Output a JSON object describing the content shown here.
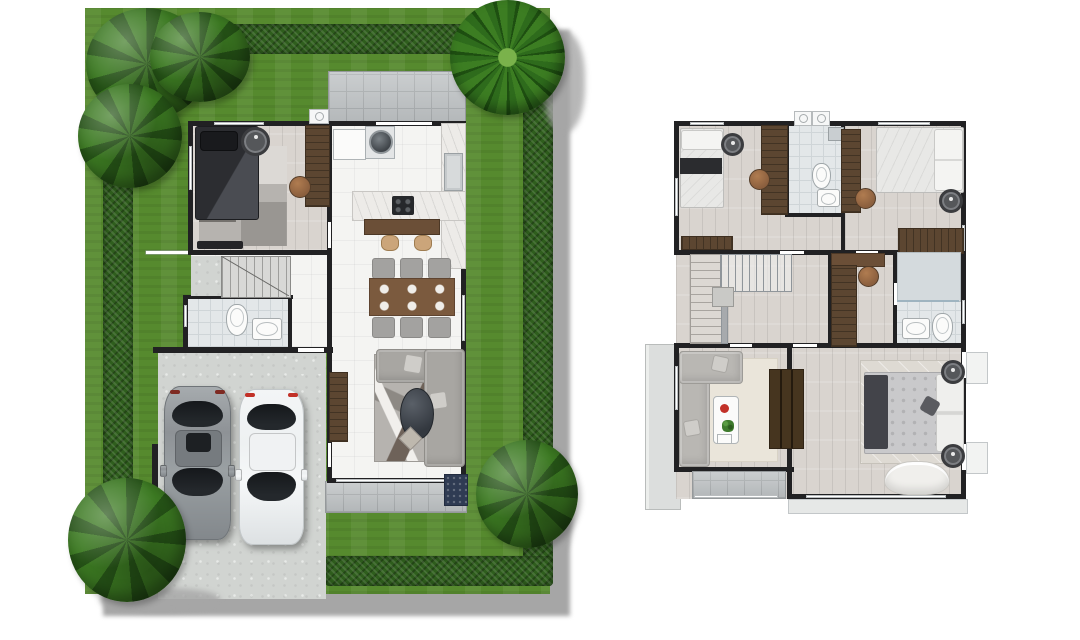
{
  "title": "two-storey-house-floor-plans",
  "canvas": {
    "width": 1080,
    "height": 640
  },
  "colors": {
    "shadow": "#a6a6a6",
    "grass": "#568a2e",
    "hedge": "#2f5e1d",
    "tree": "#3c7a22",
    "tree_dark": "#265417",
    "palm": "#2e6b1c",
    "driveway": "#d1d4d1",
    "tile": "#bcc0c2",
    "tile_line": "#a6aaac",
    "floor_white": "#f4f4f2",
    "wood": "#d9d4cf",
    "wall": "#212123",
    "bath": "#e3e7e9",
    "marble": "#edebe8",
    "furniture_wood": "#5c4631",
    "bar_wood": "#6b4f37",
    "chair_tan": "#8b5f3e",
    "stool_tan": "#cba57a",
    "sofa_gray": "#a8a6a2",
    "sofa_light": "#b9b7b3",
    "rug_gray": "#b6b3af",
    "rug_cream": "#eae5da",
    "rug_master": "#dedad3",
    "bed_dark": "#313236",
    "bed_white": "#e8e8e6",
    "blanket_navy": "#43444a",
    "car_gray": "#8e9296",
    "car_white": "#eef1f2",
    "glass": "#24282c",
    "accent_red": "#c23128",
    "plant_green": "#3e7b2d",
    "doormat_navy": "#2f3b53",
    "arc_line": "#8f979c"
  },
  "plans": [
    {
      "id": "first-floor",
      "position": "left",
      "site": {
        "lawn": "hedge-bordered garden",
        "trees": [
          "tree-top-left-cluster",
          "tree-left",
          "palm-top-right",
          "tree-bottom-left",
          "tree-bottom-right"
        ],
        "shadow": "cast-to-bottom-right"
      },
      "rooms": [
        "bedroom",
        "kitchen",
        "dining-area",
        "living-room",
        "bathroom",
        "stair-hall",
        "utility-patio",
        "entry-porch",
        "terrace",
        "carport-driveway"
      ],
      "furniture": {
        "bedroom": [
          "double-bed-dark",
          "patchwork-rug",
          "round-rug",
          "wardrobe",
          "chair",
          "tv-console"
        ],
        "kitchen": [
          "fridge",
          "washing-machine",
          "l-shaped-counter",
          "sink",
          "stove",
          "breakfast-bar",
          "bar-stools x2"
        ],
        "dining-area": [
          "dining-table",
          "dining-chairs x6"
        ],
        "living-room": [
          "l-shaped-sofa",
          "abstract-rug",
          "oval-coffee-table",
          "side-table",
          "tv-console",
          "doormat"
        ],
        "bathroom": [
          "toilet",
          "washbasin"
        ],
        "stair-hall": [
          "staircase",
          "under-stair-storage"
        ]
      },
      "vehicles": [
        "car-gray",
        "car-white"
      ],
      "exterior": [
        "ac-unit",
        "side-gate",
        "fence-stub"
      ]
    },
    {
      "id": "second-floor",
      "position": "right",
      "rooms": [
        "bedroom-2",
        "bathroom-2",
        "bedroom-3",
        "stair-hall",
        "wardrobe-nook",
        "bathroom-3",
        "family-room",
        "master-bedroom",
        "balcony-left",
        "terrace-rear",
        "juliet-balconies-right",
        "balcony-bottom"
      ],
      "furniture": {
        "bedroom-2": [
          "single-bed",
          "round-rug",
          "wardrobe",
          "chair",
          "dresser"
        ],
        "bathroom-2": [
          "shower",
          "toilet",
          "washbasin"
        ],
        "bedroom-3": [
          "double-bed",
          "wardrobe",
          "chair",
          "round-rug",
          "closet"
        ],
        "stair-hall": [
          "staircase",
          "railing",
          "newel-landing"
        ],
        "wardrobe-nook": [
          "wardrobe",
          "desk",
          "chair"
        ],
        "bathroom-3": [
          "shower",
          "glass-partition",
          "washbasin",
          "toilet"
        ],
        "family-room": [
          "l-shaped-sofa",
          "cream-rug",
          "coffee-table",
          "red-bowl",
          "plant",
          "tv-console"
        ],
        "master-bedroom": [
          "king-bed",
          "area-rug",
          "bedside-stools x2",
          "curved-lounge-sofa"
        ]
      },
      "exterior": [
        "ac-unit x2"
      ]
    }
  ]
}
